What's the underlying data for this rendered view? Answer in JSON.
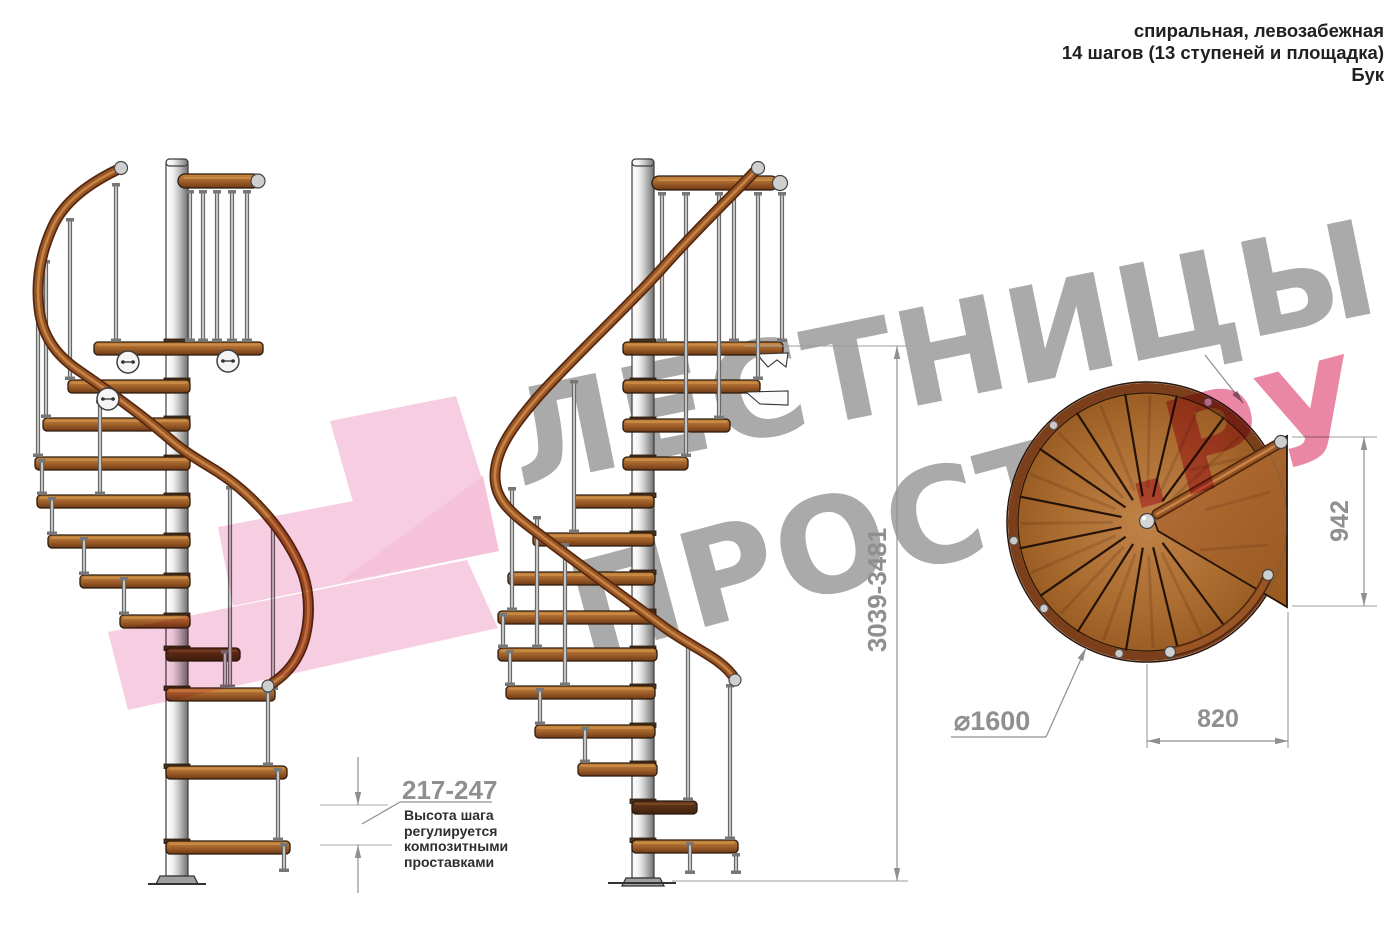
{
  "title": {
    "line1": "спиральная, левозабежная",
    "line2": "14 шагов (13 ступеней и площадка)",
    "line3": "Бук"
  },
  "watermark": {
    "line1": "ЛЕСТНИЦЫ",
    "line2": "ПРОСТО",
    "suffix": ".РУ"
  },
  "dimensions": {
    "total_height": "3039-3481",
    "landing_width": "942",
    "step_length": "820",
    "diameter": "⌀1600",
    "step_height_range": "217-247"
  },
  "annotation": {
    "lines": [
      "Высота шага",
      "регулируется",
      "композитными",
      "проставками"
    ]
  },
  "views": {
    "left_side_view": "боковой вид 1",
    "center_side_view": "боковой вид 2",
    "plan_view": "вид сверху"
  },
  "colors": {
    "watermark_pink": "#e05a86",
    "watermark_gray": "#aaaaaa",
    "logo_pink": "#f0a5c8",
    "wood": "#a96a2e",
    "wood_dark": "#6e3715",
    "metal": "#c9c9c9",
    "dimension_gray": "#8f8f8f"
  }
}
